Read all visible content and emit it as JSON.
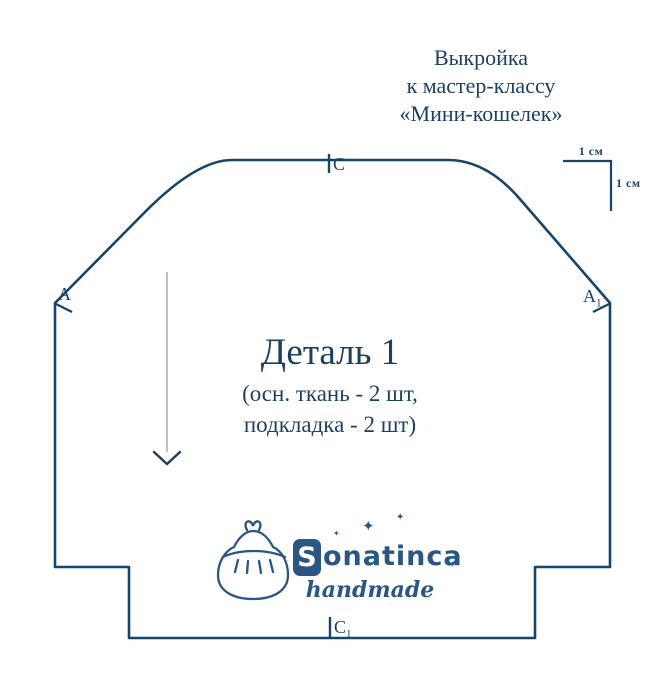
{
  "colors": {
    "outline_navy": "#164569",
    "text_navy": "#1d3f5f",
    "logo_blue": "#2a5683",
    "arrow_shaft_gray": "#b3bcc2",
    "background": "#ffffff"
  },
  "header": {
    "title_line1": "Выкройка",
    "title_line2": "к мастер-классу",
    "title_line3": "«Мини-кошелек»"
  },
  "scale": {
    "horizontal_label": "1 см",
    "vertical_label": "1 см"
  },
  "pattern": {
    "piece_title": "Деталь 1",
    "piece_note_line1": "(осн. ткань - 2 шт,",
    "piece_note_line2": "подкладка - 2 шт)",
    "labels": {
      "left": "A",
      "right_base": "A",
      "right_sub": "1",
      "top": "C",
      "bottom_base": "C",
      "bottom_sub": "1"
    }
  },
  "logo": {
    "initial": "S",
    "name_rest": "onatinca",
    "tagline": "handmade",
    "star_glyph": "✦"
  }
}
